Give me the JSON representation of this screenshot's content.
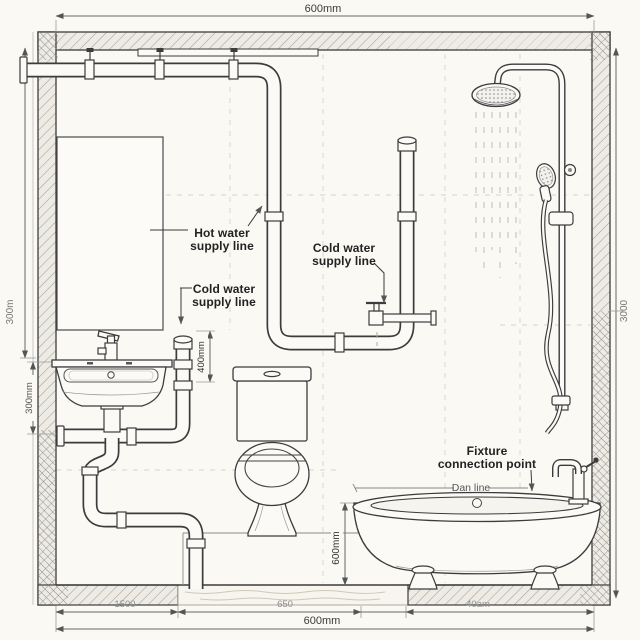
{
  "diagram": {
    "title": "Bathroom plumbing elevation diagram",
    "labels": {
      "hot_water": {
        "line1": "Hot water",
        "line2": "supply line"
      },
      "cold_water_left": {
        "line1": "Cold water",
        "line2": "supply line"
      },
      "cold_water_mid": {
        "line1": "Cold water",
        "line2": "supply line"
      },
      "fixture_connection": {
        "line1": "Fixture",
        "line2": "connection point"
      },
      "drain_line": {
        "text": "Dan line"
      }
    },
    "dimensions": {
      "top_width": "600mm",
      "bottom_width": "600mm",
      "bottom_seg_1": "1500",
      "bottom_seg_2": "650",
      "bottom_seg_3": "40am",
      "left_outer": "300m",
      "left_inner": "300mm",
      "right_height": "3000",
      "supply_drop": "400mm",
      "tub_height": "600mm"
    },
    "colors": {
      "paper": "#faf9f4",
      "ink": "#3c3c3c",
      "pipe_fill": "#fbfaf7",
      "hatch": "#a2a09a",
      "dim_text": "#777777",
      "label_text": "#222222"
    }
  }
}
